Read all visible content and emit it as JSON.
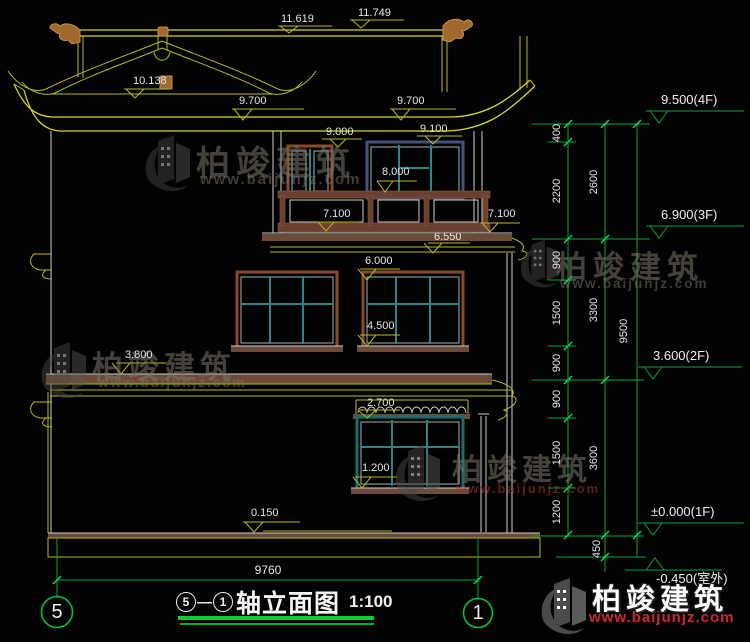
{
  "watermark": {
    "brand": "柏竣建筑",
    "site": "www.baijunjz.com"
  },
  "markers": {
    "m11619": "11.619",
    "m11749": "11.749",
    "m10138": "10.138",
    "m9700": "9.700",
    "m9000": "9.000",
    "m9100": "9.100",
    "m8000": "8.000",
    "m7100": "7.100",
    "m6550": "6.550",
    "m6000": "6.000",
    "m4500": "4.500",
    "m3800": "3.800",
    "m2700": "2.700",
    "m1200": "1.200",
    "m0150": "0.150"
  },
  "floor_markers": {
    "f4": "9.500(4F)",
    "f3": "6.900(3F)",
    "f2": "3.600(2F)",
    "f1": "±0.000(1F)",
    "fb": "-0.450(室外)"
  },
  "dims": {
    "d400": "400",
    "d2200": "2200",
    "d900": "900",
    "d1500": "1500",
    "d1200": "1200",
    "d2600": "2600",
    "d3300": "3300",
    "d3600": "3600",
    "d450": "450",
    "d9500": "9500",
    "total": "9760"
  },
  "title": {
    "axis_start": "5",
    "axis_end": "1",
    "dash": "—",
    "name": "轴立面图",
    "scale": "1:100"
  },
  "grid": {
    "left": "5",
    "right": "1"
  },
  "colors": {
    "line_yellow": "#b9b91e",
    "line_white": "#d0d0d0",
    "dim_green": "#00a53c",
    "band_brown": "#6b4a3a",
    "frame_teal": "#2a8585",
    "ornament": "#a2692f"
  }
}
